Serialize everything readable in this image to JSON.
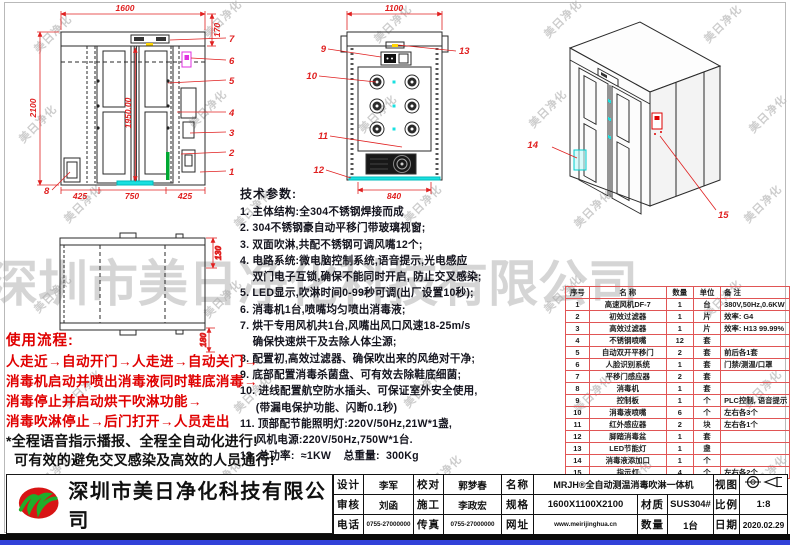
{
  "watermark": {
    "small": "美日净化",
    "large": "深圳市美日净化科技有限公司"
  },
  "company": {
    "name": "深圳市美日净化科技有限公司",
    "logo": "MR"
  },
  "drawings": {
    "front": {
      "dim_width": "1600",
      "dim_cap": "170",
      "dim_height": "2100",
      "dim_door": "1950.00",
      "dim_b1": "425",
      "dim_b2": "750",
      "dim_b3": "425",
      "callouts": [
        "1",
        "2",
        "3",
        "4",
        "5",
        "6",
        "7",
        "8"
      ]
    },
    "top_view": {
      "dim_width": "1100",
      "dim_inner": "840",
      "callouts": [
        "9",
        "10",
        "11",
        "12",
        "13"
      ]
    },
    "iso": {
      "callouts": [
        "14",
        "15"
      ]
    },
    "plan": {
      "dim_r1": "130",
      "dim_r2": "180"
    }
  },
  "specs": {
    "title": "技术参数:",
    "lines": [
      "1. 主体结构:全304不锈钢焊接而成",
      "2. 304不锈钢豪自动平移门带玻璃视窗;",
      "3. 双面吹淋,共配不锈钢可调风嘴12个;",
      "4. 电路系统:微电脑控制系统,语音提示,光电感应",
      "    双门电子互锁,确保不能同时开启, 防止交叉感染;",
      "5. LED显示,吹淋时间0-99秒可调(出厂设置10秒);",
      "6. 消毒机1台,喷嘴均匀喷出消毒液;",
      "7. 烘干专用风机共1台,风嘴出风口风速18-25m/s",
      "    确保快速烘干及去除人体尘源;",
      "8. 配置初,高效过滤器、确保吹出来的风绝对干净;",
      "9. 底部配置消毒杀菌盘、可有效去除鞋底细菌;",
      "10. 进线配置航空防水插头、可保证室外安全使用,",
      "     (带漏电保护功能、闪断0.1秒)",
      "11. 顶部配节能照明灯:220V/50Hz,21W*1盏,",
      "     风机电源:220V/50Hz,750W*1台.",
      "12. 总功率:  ≈1KW    总重量:  300Kg"
    ]
  },
  "usage": {
    "title": "使用流程:",
    "steps": [
      "人走近→自动开门→人走进→自动关门→",
      "消毒机启动并喷出消毒液同时鞋底消毒→",
      "消毒停止并启动烘干吹淋功能→",
      "消毒吹淋停止→后门打开→人员走出"
    ],
    "notes": [
      "*全程语音指示播报、全程全自动化进行!",
      "  可有效的避免交叉感染及高效的人员通行!"
    ]
  },
  "parts_table": {
    "headers": [
      "序号",
      "名  称",
      "数量",
      "单位",
      "备  注"
    ],
    "rows": [
      [
        "1",
        "高速风机DF-7",
        "1",
        "台",
        "380V,50Hz,0.6KW"
      ],
      [
        "2",
        "初效过滤器",
        "1",
        "片",
        "效率: G4"
      ],
      [
        "3",
        "高效过滤器",
        "1",
        "片",
        "效率: H13 99.99%"
      ],
      [
        "4",
        "不锈钢喷嘴",
        "12",
        "套",
        ""
      ],
      [
        "5",
        "自动双开平移门",
        "2",
        "套",
        "前后各1套"
      ],
      [
        "6",
        "人脸识别系统",
        "1",
        "套",
        "门禁/测温/口罩"
      ],
      [
        "7",
        "平移门感应器",
        "2",
        "套",
        ""
      ],
      [
        "8",
        "消毒机",
        "1",
        "套",
        ""
      ],
      [
        "9",
        "控制板",
        "1",
        "个",
        "PLC控制, 语音提示"
      ],
      [
        "10",
        "消毒液喷嘴",
        "6",
        "个",
        "左右各3个"
      ],
      [
        "11",
        "红外感应器",
        "2",
        "块",
        "左右各1个"
      ],
      [
        "12",
        "脚踏消毒盆",
        "1",
        "套",
        ""
      ],
      [
        "13",
        "LED节能灯",
        "1",
        "盏",
        ""
      ],
      [
        "14",
        "消毒液添加口",
        "1",
        "个",
        ""
      ],
      [
        "15",
        "指示灯",
        "4",
        "个",
        "左右各2个"
      ]
    ]
  },
  "title_block": {
    "design_label": "设计",
    "design": "李军",
    "check_label": "校对",
    "check": "郭梦春",
    "name_label": "名称",
    "name": "MRJH®全自动测温消毒吹淋一体机",
    "view_label": "视图",
    "audit_label": "审核",
    "audit": "刘函",
    "build_label": "施工",
    "build": "李政宏",
    "spec_label": "规格",
    "spec": "1600X1100X2100",
    "material_label": "材质",
    "material": "SUS304#",
    "scale_label": "比例",
    "scale": "1:8",
    "tel_label": "电话",
    "tel": "0755-27000000",
    "fax_label": "传真",
    "fax": "0755-27000000",
    "web_label": "网址",
    "web": "www.meirijinghua.cn",
    "qty_label": "数量",
    "qty": "1台",
    "date_label": "日期",
    "date": "2020.02.29"
  },
  "colors": {
    "dim_red": "#e02020",
    "cyan": "#19e0e0",
    "magenta": "#e030e0",
    "green": "#00a832",
    "blue_bar": "#3141d8",
    "flow_red": "#e00000"
  }
}
